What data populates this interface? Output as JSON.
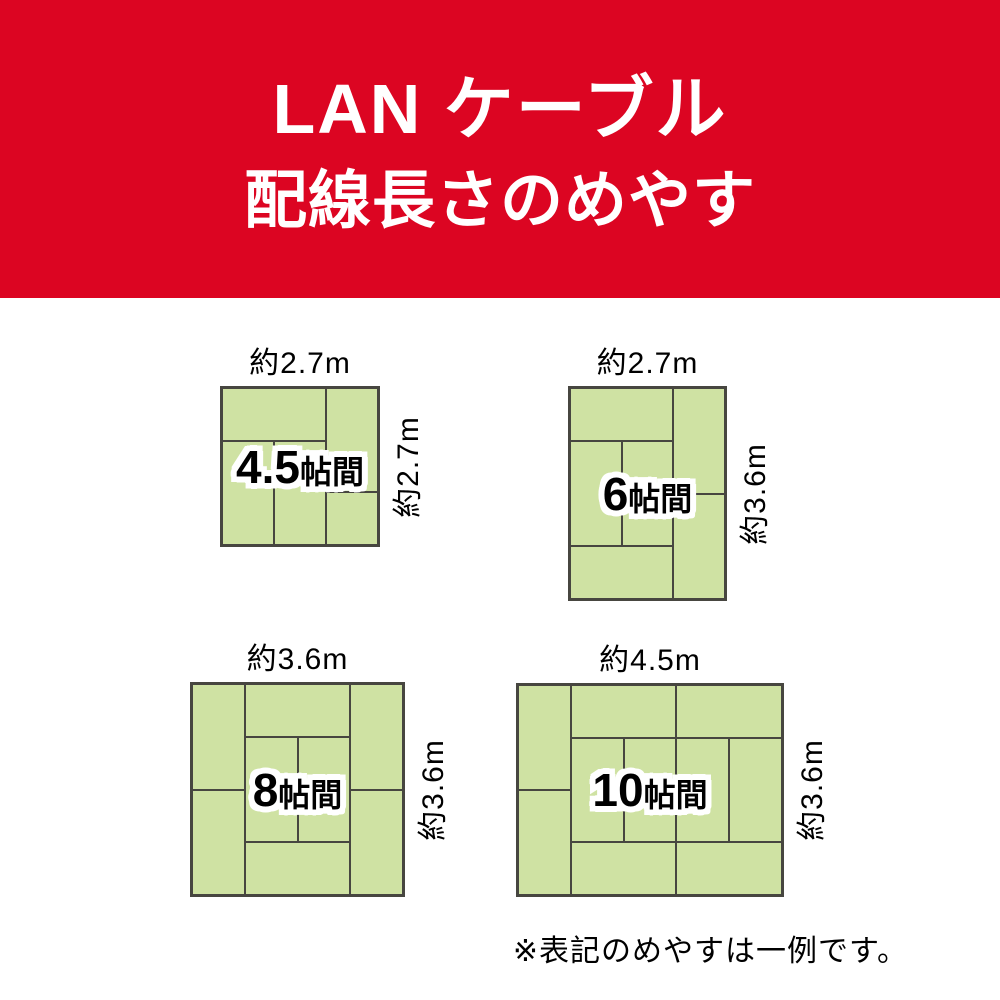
{
  "header": {
    "title_line1": "LAN ケーブル",
    "title_line2": "配線長さのめやす",
    "bg_color": "#dc0522",
    "text_color": "#ffffff"
  },
  "colors": {
    "tatami_fill": "#cfe2a3",
    "tatami_line": "#474640",
    "label_outline": "#ffffff",
    "text": "#000000"
  },
  "rooms": [
    {
      "id": "4-5jo",
      "size_value": "4.5",
      "size_unit": "帖間",
      "width_label": "約2.7m",
      "height_label": "約2.7m",
      "box": {
        "left": 220,
        "top": 386,
        "width": 160,
        "height": 161
      },
      "lines": [
        {
          "o": "v",
          "pos": 0.6667,
          "from": 0,
          "to": 1
        },
        {
          "o": "v",
          "pos": 0.3333,
          "from": 0.3333,
          "to": 1
        },
        {
          "o": "h",
          "pos": 0.3333,
          "from": 0,
          "to": 0.6667
        },
        {
          "o": "h",
          "pos": 0.6667,
          "from": 0.6667,
          "to": 1
        }
      ]
    },
    {
      "id": "6jo",
      "size_value": "6",
      "size_unit": "帖間",
      "width_label": "約2.7m",
      "height_label": "約3.6m",
      "box": {
        "left": 568,
        "top": 386,
        "width": 159,
        "height": 215
      },
      "lines": [
        {
          "o": "v",
          "pos": 0.6667,
          "from": 0,
          "to": 1
        },
        {
          "o": "v",
          "pos": 0.3333,
          "from": 0.25,
          "to": 0.75
        },
        {
          "o": "h",
          "pos": 0.25,
          "from": 0,
          "to": 0.6667
        },
        {
          "o": "h",
          "pos": 0.75,
          "from": 0,
          "to": 0.6667
        },
        {
          "o": "h",
          "pos": 0.5,
          "from": 0.6667,
          "to": 1
        }
      ]
    },
    {
      "id": "8jo",
      "size_value": "8",
      "size_unit": "帖間",
      "width_label": "約3.6m",
      "height_label": "約3.6m",
      "box": {
        "left": 190,
        "top": 682,
        "width": 215,
        "height": 215
      },
      "lines": [
        {
          "o": "v",
          "pos": 0.25,
          "from": 0,
          "to": 1
        },
        {
          "o": "v",
          "pos": 0.75,
          "from": 0,
          "to": 1
        },
        {
          "o": "v",
          "pos": 0.5,
          "from": 0.25,
          "to": 0.75
        },
        {
          "o": "h",
          "pos": 0.25,
          "from": 0.25,
          "to": 0.75
        },
        {
          "o": "h",
          "pos": 0.75,
          "from": 0.25,
          "to": 0.75
        },
        {
          "o": "h",
          "pos": 0.5,
          "from": 0,
          "to": 0.25
        },
        {
          "o": "h",
          "pos": 0.5,
          "from": 0.75,
          "to": 1
        }
      ]
    },
    {
      "id": "10jo",
      "size_value": "10",
      "size_unit": "帖間",
      "width_label": "約4.5m",
      "height_label": "約3.6m",
      "box": {
        "left": 516,
        "top": 683,
        "width": 268,
        "height": 214
      },
      "lines": [
        {
          "o": "v",
          "pos": 0.2,
          "from": 0,
          "to": 1
        },
        {
          "o": "v",
          "pos": 0.6,
          "from": 0,
          "to": 1
        },
        {
          "o": "v",
          "pos": 0.4,
          "from": 0.25,
          "to": 0.75
        },
        {
          "o": "v",
          "pos": 0.8,
          "from": 0.25,
          "to": 0.75
        },
        {
          "o": "h",
          "pos": 0.25,
          "from": 0.2,
          "to": 1
        },
        {
          "o": "h",
          "pos": 0.75,
          "from": 0.2,
          "to": 1
        },
        {
          "o": "h",
          "pos": 0.5,
          "from": 0,
          "to": 0.2
        }
      ]
    }
  ],
  "footnote": {
    "text": "※表記のめやすは一例です。"
  }
}
